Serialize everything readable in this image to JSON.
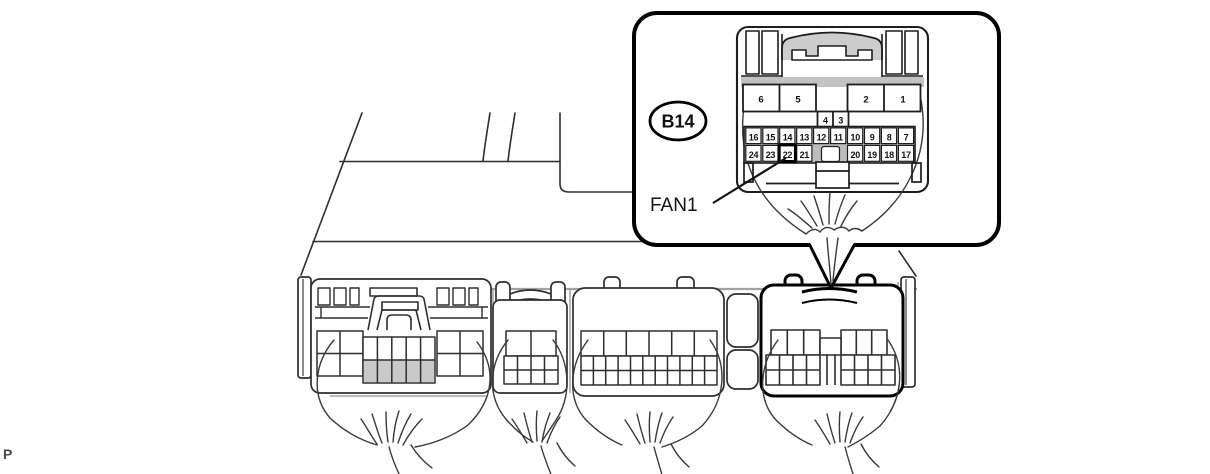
{
  "page_marker": "P",
  "colors": {
    "line": "#2e2e2e",
    "bold_line": "#000000",
    "gray_line": "#9e9e9e",
    "cell_grid_gray": "#bdbdbd",
    "shade_gray": "#c9c9c9"
  },
  "callout": {
    "connector_id": "B14",
    "signal_label": "FAN1",
    "highlighted_pin": "22",
    "pins": {
      "large": [
        "6",
        "5",
        "2",
        "1"
      ],
      "center_small": [
        "4",
        "3"
      ],
      "row_upper": [
        "16",
        "15",
        "14",
        "13",
        "12",
        "11",
        "10",
        "9",
        "8",
        "7"
      ],
      "row_lower_left": [
        "24",
        "23",
        "22",
        "21"
      ],
      "row_lower_right": [
        "20",
        "19",
        "18",
        "17"
      ]
    }
  }
}
